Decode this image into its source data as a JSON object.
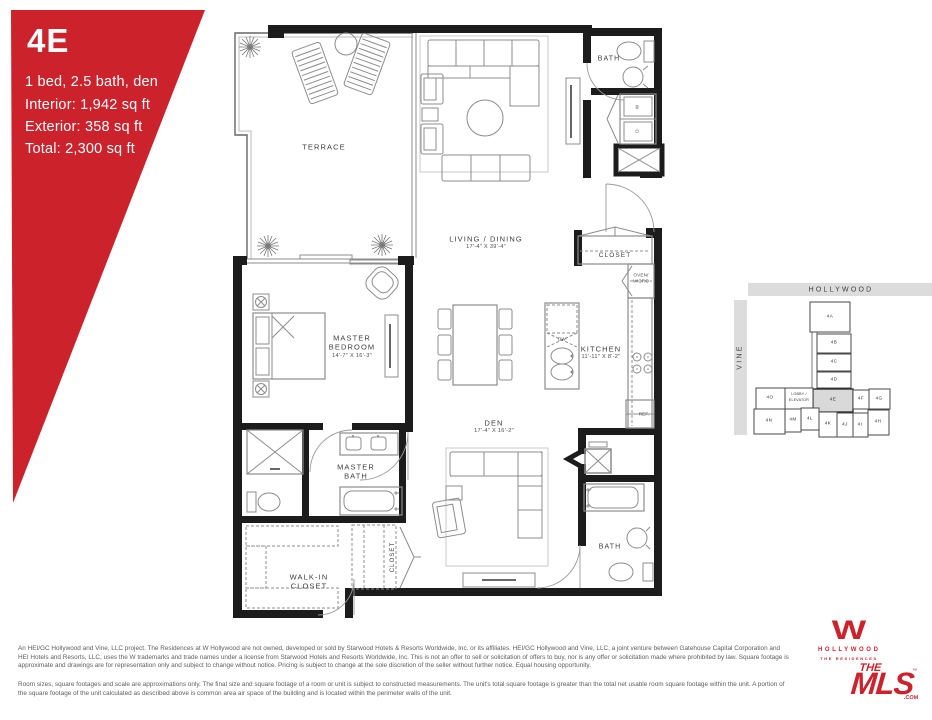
{
  "unit_card": {
    "unit": "4E",
    "config": "1 bed, 2.5 bath, den",
    "interior": "Interior: 1,942 sq ft",
    "exterior": "Exterior: 358 sq ft",
    "total": "Total: 2,300 sq ft"
  },
  "plan": {
    "terrace": "TERRACE",
    "living_dining": "LIVING / DINING",
    "living_dining_dims": "17'-4\" X 39'-4\"",
    "bath_upper": "BATH",
    "washer": "W",
    "dryer": "D",
    "entry_closet": "CLOSET",
    "oven_micro_line1": "OVEN/",
    "oven_micro_line2": "MICRO",
    "master_bedroom_line1": "MASTER",
    "master_bedroom_line2": "BEDROOM",
    "master_bedroom_dims": "14'-7\" X 16'-3\"",
    "kitchen": "KITCHEN",
    "kitchen_dims": "11'-11\" X 8'-2\"",
    "dishwasher": "DW",
    "refrigerator": "REF.",
    "den": "DEN",
    "den_dims": "17'-4\" X 16'-2\"",
    "master_bath_line1": "MASTER",
    "master_bath_line2": "BATH",
    "walk_in_closet_line1": "WALK-IN",
    "walk_in_closet_line2": "CLOSET",
    "hall_closet": "CLOSET",
    "bath_lower": "BATH"
  },
  "key_map": {
    "street_top": "HOLLYWOOD",
    "street_left": "VINE",
    "lobby_line1": "LOBBY /",
    "lobby_line2": "ELEVATOR",
    "highlighted_unit": "4E",
    "units": [
      "4A",
      "4B",
      "4C",
      "4D",
      "4E",
      "4F",
      "4G",
      "4O",
      "4N",
      "4M",
      "4L",
      "4K",
      "4J",
      "4I",
      "4H"
    ]
  },
  "footer": {
    "disclaimer_1": "An HEI/GC Hollywood and Vine, LLC project. The Residences at W Hollywood are not owned, developed or sold by Starwood Hotels & Resorts Worldwide, Inc. or its affiliates. HEI/GC Hollywood and Vine, LLC, a joint venture between Gatehouse Capital Corporation and HEI Hotels and Resorts, LLC, uses the W trademarks and trade names under a license from Starwood Hotels and Resorts Worldwide, Inc. This is not an offer to sell or solicitation of offers to buy, nor is any offer or solicitation made where prohibited by law. Square footage is approximate and drawings are for representation only and subject to change without notice. Pricing is subject to change at the sole discretion of the seller without further notice. Equal housing opportunity.",
    "disclaimer_2": "Room sizes, square footages and scale are approximations only. The final size and square footage of a room or unit is subject to constructed measurements. The unit's total square footage is greater than the total net usable room square footage within the unit. A portion of the square footage of the unit calculated as described above is common area air space of the building and is located within the perimeter walls of the unit."
  },
  "logos": {
    "w": "W",
    "hollywood": "HOLLYWOOD",
    "residences": "THE RESIDENCES",
    "mls_the": "THE",
    "mls_main": "MLS",
    "mls_com": ".COM",
    "mls_tm": "™"
  },
  "colors": {
    "accent_red": "#cb222c",
    "wall_black": "#1c1c1c",
    "map_street_gray": "#dcdcdc",
    "highlight_gray": "#d9d9d9"
  }
}
